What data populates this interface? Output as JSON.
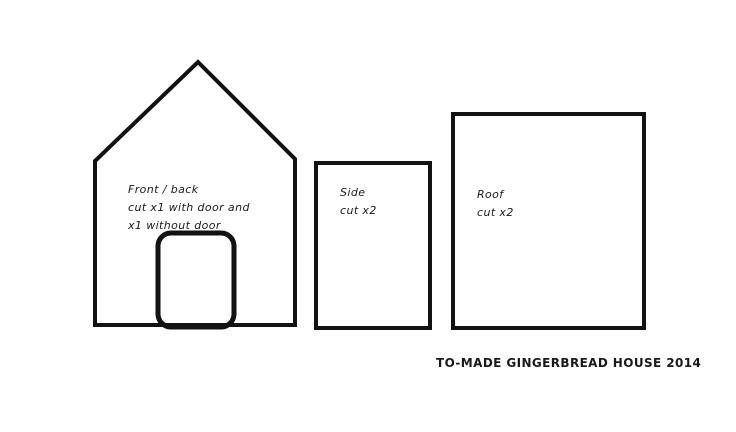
{
  "diagram": {
    "panels": [
      {
        "id": "front_back",
        "label_lines": [
          "Front / back",
          "cut x1 with door and",
          "x1 without door"
        ]
      },
      {
        "id": "side",
        "label_lines": [
          "Side",
          "cut x2"
        ]
      },
      {
        "id": "roof",
        "label_lines": [
          "Roof",
          "cut x2"
        ]
      }
    ],
    "caption": "TO-MADE GINGERBREAD HOUSE 2014",
    "colors": {
      "outline": "#121212",
      "background": "#ffffff",
      "text": "#1a1a1a"
    }
  }
}
